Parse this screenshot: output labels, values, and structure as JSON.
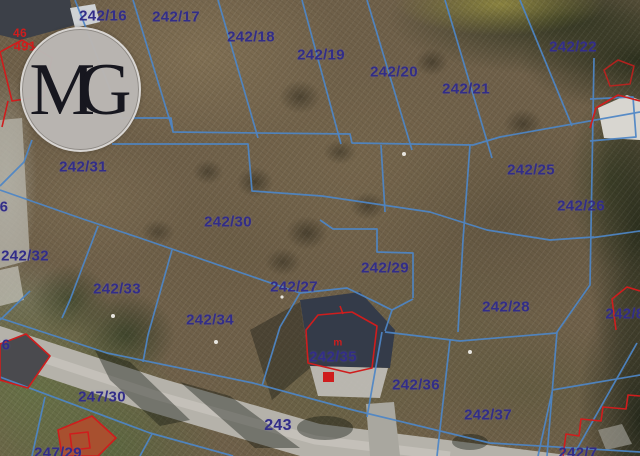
{
  "map": {
    "kind": "aerial-cadastral-parcel-map"
  },
  "watermark": {
    "m": "M",
    "g": "G"
  },
  "colors": {
    "boundary_blue": "#4e86c6",
    "label_navy": "#322d88",
    "building_red": "#cf1d1d",
    "road_gray": "#b5b2aa"
  },
  "labels": [
    {
      "text": "242/16",
      "x": 103,
      "y": 16,
      "kind": "parcel"
    },
    {
      "text": "242/17",
      "x": 176,
      "y": 17,
      "kind": "parcel"
    },
    {
      "text": "242/18",
      "x": 251,
      "y": 37,
      "kind": "parcel"
    },
    {
      "text": "242/19",
      "x": 321,
      "y": 55,
      "kind": "parcel"
    },
    {
      "text": "242/20",
      "x": 394,
      "y": 72,
      "kind": "parcel"
    },
    {
      "text": "242/21",
      "x": 466,
      "y": 89,
      "kind": "parcel"
    },
    {
      "text": "242/22",
      "x": 573,
      "y": 47,
      "kind": "parcel"
    },
    {
      "text": "242/25",
      "x": 531,
      "y": 170,
      "kind": "parcel"
    },
    {
      "text": "242/26",
      "x": 581,
      "y": 206,
      "kind": "parcel"
    },
    {
      "text": "242/31",
      "x": 83,
      "y": 167,
      "kind": "parcel"
    },
    {
      "text": "242/30",
      "x": 228,
      "y": 222,
      "kind": "parcel"
    },
    {
      "text": "242/32",
      "x": 25,
      "y": 256,
      "kind": "parcel"
    },
    {
      "text": "242/33",
      "x": 117,
      "y": 289,
      "kind": "parcel"
    },
    {
      "text": "242/34",
      "x": 210,
      "y": 320,
      "kind": "parcel"
    },
    {
      "text": "242/27",
      "x": 294,
      "y": 287,
      "kind": "parcel"
    },
    {
      "text": "242/29",
      "x": 385,
      "y": 268,
      "kind": "parcel"
    },
    {
      "text": "242/28",
      "x": 506,
      "y": 307,
      "kind": "parcel"
    },
    {
      "text": "242/35",
      "x": 333,
      "y": 357,
      "kind": "parcel"
    },
    {
      "text": "242/36",
      "x": 416,
      "y": 385,
      "kind": "parcel"
    },
    {
      "text": "242/37",
      "x": 488,
      "y": 415,
      "kind": "parcel"
    },
    {
      "text": "243",
      "x": 278,
      "y": 426,
      "kind": "parcel",
      "size": 16
    },
    {
      "text": "247/30",
      "x": 102,
      "y": 397,
      "kind": "parcel"
    },
    {
      "text": "247/29",
      "x": 58,
      "y": 453,
      "kind": "parcel"
    },
    {
      "text": "242/8",
      "x": 625,
      "y": 314,
      "kind": "parcel"
    },
    {
      "text": "242/7",
      "x": 578,
      "y": 453,
      "kind": "parcel"
    },
    {
      "text": "6",
      "x": 4,
      "y": 207,
      "kind": "parcel"
    },
    {
      "text": "6",
      "x": 6,
      "y": 345,
      "kind": "parcel"
    },
    {
      "text": "46",
      "x": 20,
      "y": 33,
      "kind": "red",
      "size": 12
    },
    {
      "text": "491",
      "x": 25,
      "y": 46,
      "kind": "red",
      "size": 13
    },
    {
      "text": "m",
      "x": 338,
      "y": 343,
      "kind": "red",
      "size": 10
    }
  ]
}
